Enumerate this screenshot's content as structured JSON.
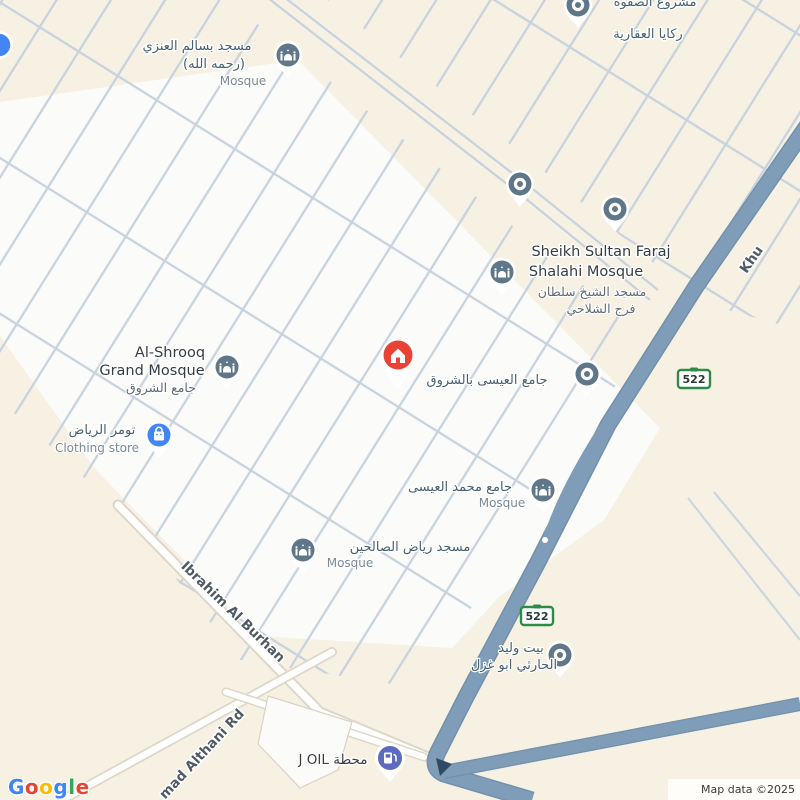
{
  "map": {
    "attribution": "Map data ©2025",
    "colors": {
      "background": "#f6f1e3",
      "residential": "#fbfbf9",
      "street_line": "#c6d2dd",
      "highway": "#7f9db8",
      "highway_casing": "#7290aa",
      "poi_pin": "#5f7788",
      "store_pin": "#4285f4",
      "fuel_pin": "#5c6bc0",
      "marker_red": "#ea4335",
      "shield_green": "#2e8b46"
    },
    "pois": {
      "salem": {
        "line1": "مسجد بسالم العنزي",
        "line2": "(رحمه الله)",
        "type_label": "Mosque"
      },
      "rakaya": {
        "line1": "مشروع الصفوة",
        "line2": "ركايا العقارية"
      },
      "sheikh": {
        "en_line1": "Sheikh Sultan Faraj",
        "en_line2": "Shalahi Mosque",
        "ar_line1": "مسجد الشيخ سلطان",
        "ar_line2": "فرج الشلاحي"
      },
      "eisa_shrooq": {
        "label": "جامع العيسى بالشروق"
      },
      "shrooq": {
        "en_line1": "Al-Shrooq",
        "en_line2": "Grand Mosque",
        "ar_label": "جامع الشروق"
      },
      "tomer": {
        "ar_label": "تومر الرياض",
        "type_label": "Clothing store"
      },
      "mohammed_eisa": {
        "label": "جامع محمد العيسى",
        "type_label": "Mosque"
      },
      "riyadh_salihin": {
        "label": "مسجد رياض الصالحين",
        "type_label": "Mosque"
      },
      "bait_waleed": {
        "line1": "بيت وليد",
        "line2": "الحارثي ابو غزل"
      },
      "joil": {
        "label": "محطة J OIL"
      }
    },
    "roads": {
      "ibrahim": "Ibrahim Al Burhan",
      "althani_partial": "mad Althani Rd",
      "khurais_partial": "Khu"
    },
    "shields": [
      {
        "number": "522"
      },
      {
        "number": "522"
      }
    ],
    "google_logo": {
      "letters": [
        {
          "ch": "G",
          "color": "#4285F4"
        },
        {
          "ch": "o",
          "color": "#EA4335"
        },
        {
          "ch": "o",
          "color": "#FBBC05"
        },
        {
          "ch": "g",
          "color": "#4285F4"
        },
        {
          "ch": "l",
          "color": "#34A853"
        },
        {
          "ch": "e",
          "color": "#EA4335"
        }
      ]
    }
  }
}
